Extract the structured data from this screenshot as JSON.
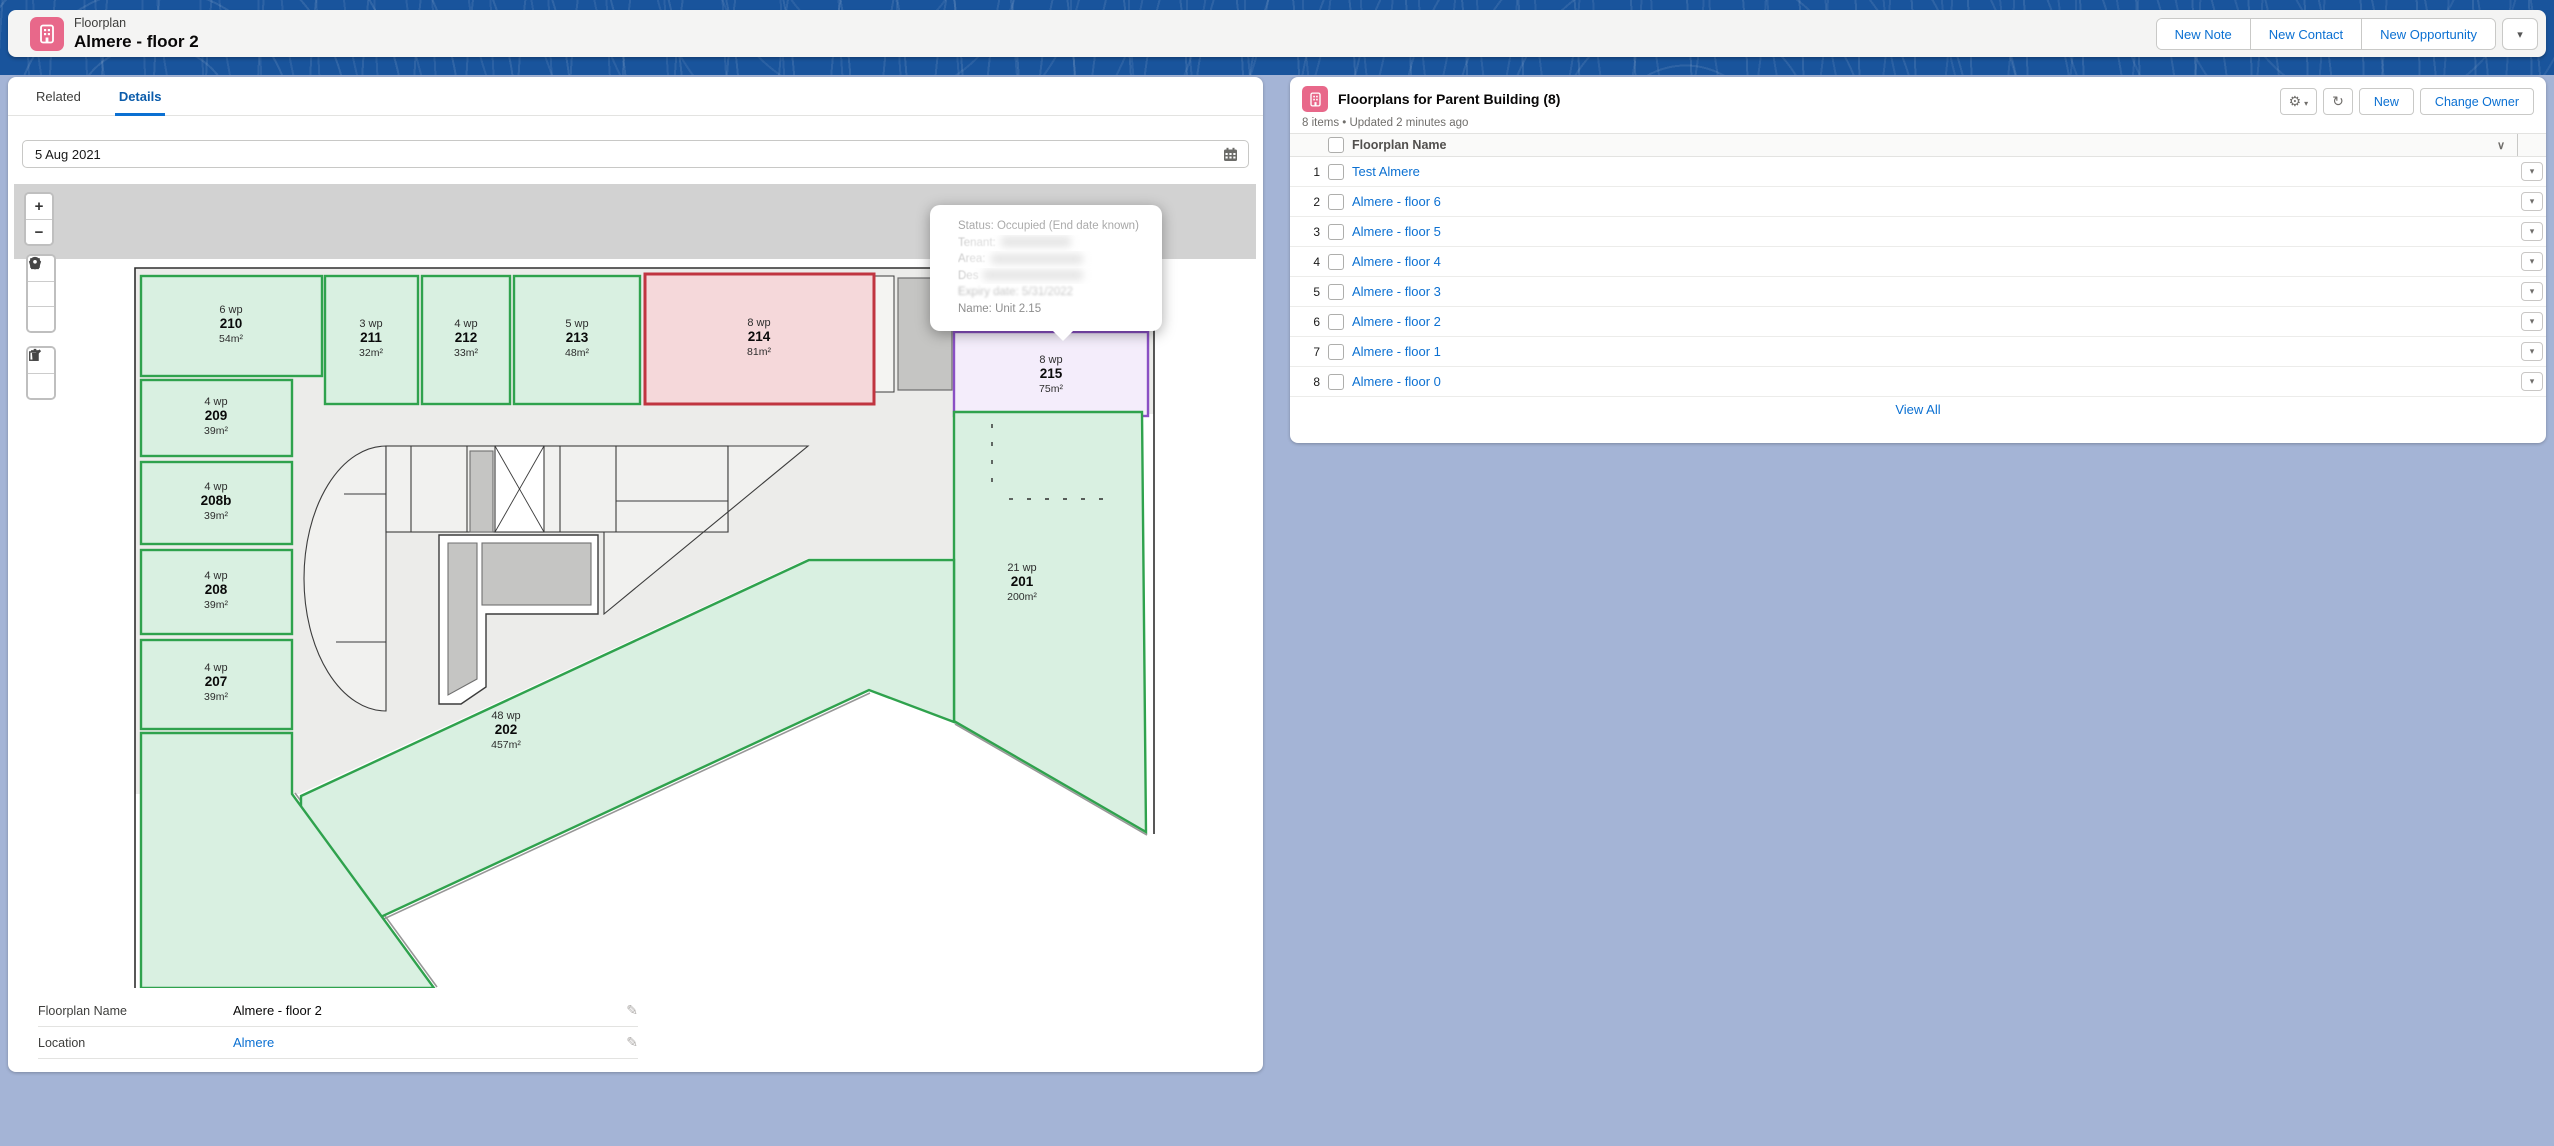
{
  "icons": {
    "pencil": "✎",
    "dropdown": "▾",
    "chevron": "∨",
    "gear": "⚙",
    "refresh": "↻"
  },
  "header": {
    "entity_label": "Floorplan",
    "record_title": "Almere - floor 2",
    "actions": [
      "New Note",
      "New Contact",
      "New Opportunity"
    ],
    "more_actions_icon": "▾"
  },
  "left_panel": {
    "tabs": [
      {
        "label": "Related",
        "active": false
      },
      {
        "label": "Details",
        "active": true
      }
    ],
    "date_field": {
      "value": "5 Aug 2021"
    },
    "record_fields": [
      {
        "label": "Floorplan Name",
        "value": "Almere - floor 2",
        "is_link": false
      },
      {
        "label": "Location",
        "value": "Almere",
        "is_link": true
      }
    ]
  },
  "map": {
    "zoom_in_label": "+",
    "zoom_out_label": "−",
    "status_colors": {
      "vacant": {
        "fill": "#d9f0e1",
        "stroke": "#2fa24d"
      },
      "occupied": {
        "fill": "#f5d8da",
        "stroke": "#c03540"
      },
      "occupied_end_date_known": {
        "fill": "#f4edfb",
        "stroke": "#8a50c4"
      }
    },
    "rooms": [
      {
        "id": "210",
        "wp": "6 wp",
        "area": "54m²",
        "status": "vacant",
        "x": 127,
        "y": 92,
        "w": 181,
        "h": 100,
        "lx": 217,
        "ly": 142
      },
      {
        "id": "209",
        "wp": "4 wp",
        "area": "39m²",
        "status": "vacant",
        "x": 127,
        "y": 196,
        "w": 151,
        "h": 76,
        "lx": 202,
        "ly": 234
      },
      {
        "id": "208b",
        "wp": "4 wp",
        "area": "39m²",
        "status": "vacant",
        "x": 127,
        "y": 278,
        "w": 151,
        "h": 82,
        "lx": 202,
        "ly": 319
      },
      {
        "id": "208",
        "wp": "4 wp",
        "area": "39m²",
        "status": "vacant",
        "x": 127,
        "y": 366,
        "w": 151,
        "h": 84,
        "lx": 202,
        "ly": 408
      },
      {
        "id": "207",
        "wp": "4 wp",
        "area": "39m²",
        "status": "vacant",
        "x": 127,
        "y": 456,
        "w": 151,
        "h": 89,
        "lx": 202,
        "ly": 500
      },
      {
        "id": "211",
        "wp": "3 wp",
        "area": "32m²",
        "status": "vacant",
        "x": 311,
        "y": 92,
        "w": 93,
        "h": 128,
        "lx": 357,
        "ly": 156
      },
      {
        "id": "212",
        "wp": "4 wp",
        "area": "33m²",
        "status": "vacant",
        "x": 408,
        "y": 92,
        "w": 88,
        "h": 128,
        "lx": 452,
        "ly": 156
      },
      {
        "id": "213",
        "wp": "5 wp",
        "area": "48m²",
        "status": "vacant",
        "x": 500,
        "y": 92,
        "w": 126,
        "h": 128,
        "lx": 563,
        "ly": 156
      },
      {
        "id": "214",
        "wp": "8 wp",
        "area": "81m²",
        "status": "occupied",
        "x": 631,
        "y": 90,
        "w": 229,
        "h": 130,
        "lx": 745,
        "ly": 155
      },
      {
        "id": "215",
        "wp": "8 wp",
        "area": "75m²",
        "status": "occupied_end_date_known",
        "x": 940,
        "y": 148,
        "w": 194,
        "h": 84,
        "lx": 1037,
        "ly": 192
      },
      {
        "id": "201",
        "wp": "21 wp",
        "area": "200m²",
        "status": "vacant",
        "points": "940,228 1128,228 1132,648 940,537",
        "lx": 1008,
        "ly": 400
      },
      {
        "id": "202",
        "wp": "48 wp",
        "area": "457m²",
        "status": "vacant",
        "points": "287,612 795,376 940,376 940,538 855,506 287,770",
        "lx": 492,
        "ly": 548
      },
      {
        "id": "",
        "wp": "",
        "area": "",
        "status": "vacant",
        "points": "127,549 278,549 278,610 420,804 127,804"
      }
    ],
    "tooltip": {
      "lines": [
        {
          "text": "Status: Occupied (End date known)",
          "style": "faint",
          "redacted": false
        },
        {
          "text": "Tenant:",
          "style": "redacted",
          "redacted": true
        },
        {
          "text": "Area:",
          "style": "redacted",
          "redacted": true
        },
        {
          "text": "Des",
          "style": "redacted",
          "redacted": true
        },
        {
          "text": "Expiry date: 5/31/2022",
          "style": "blurred",
          "redacted": false
        },
        {
          "text": "Name: Unit 2.15",
          "style": "normal",
          "redacted": false
        }
      ]
    }
  },
  "related_list": {
    "title": "Floorplans for Parent Building (8)",
    "meta": "8 items • Updated 2 minutes ago",
    "buttons": [
      "New",
      "Change Owner"
    ],
    "columns": [
      "Floorplan Name"
    ],
    "rows": [
      {
        "num": "1",
        "name": "Test Almere"
      },
      {
        "num": "2",
        "name": "Almere - floor 6"
      },
      {
        "num": "3",
        "name": "Almere - floor 5"
      },
      {
        "num": "4",
        "name": "Almere - floor 4"
      },
      {
        "num": "5",
        "name": "Almere - floor 3"
      },
      {
        "num": "6",
        "name": "Almere - floor 2"
      },
      {
        "num": "7",
        "name": "Almere - floor 1"
      },
      {
        "num": "8",
        "name": "Almere - floor 0"
      }
    ],
    "view_all_label": "View All"
  }
}
